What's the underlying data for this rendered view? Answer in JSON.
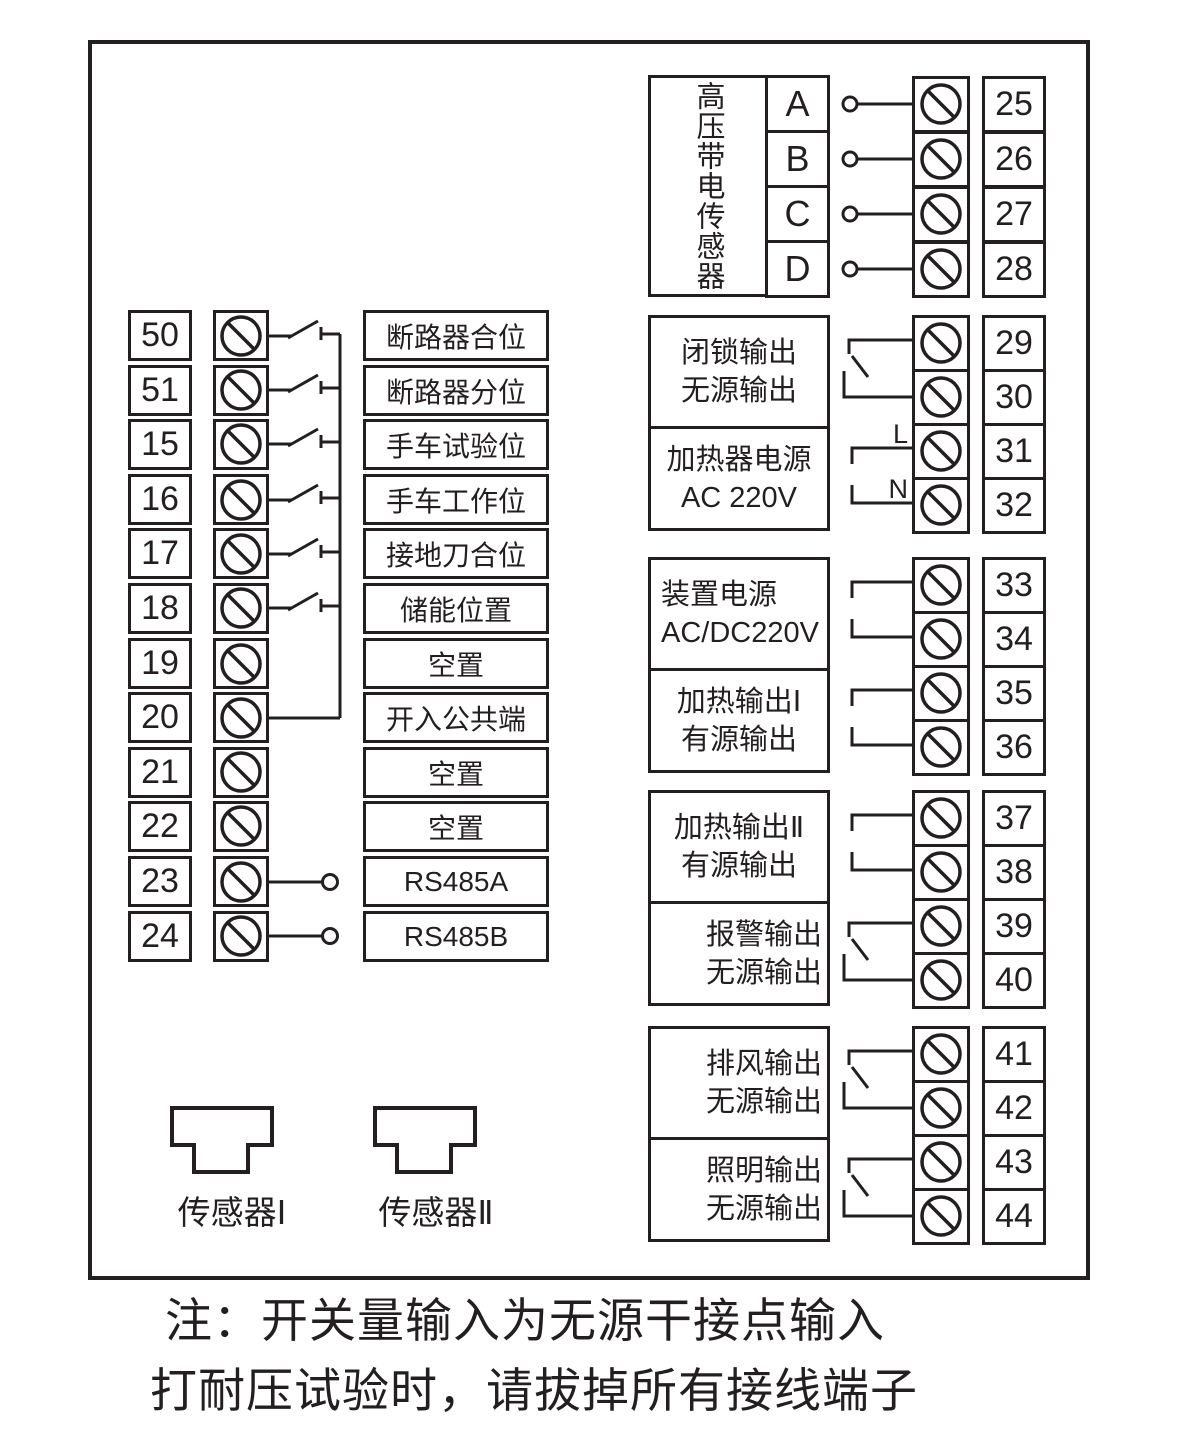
{
  "colors": {
    "ink": "#231f20",
    "background": "#ffffff"
  },
  "hv_sensor": {
    "title": "高压带电传感器",
    "pins": [
      {
        "pin": "A",
        "terminal": "25"
      },
      {
        "pin": "B",
        "terminal": "26"
      },
      {
        "pin": "C",
        "terminal": "27"
      },
      {
        "pin": "D",
        "terminal": "28"
      }
    ]
  },
  "inputs": {
    "rows": [
      {
        "terminal": "50",
        "label": "断路器合位",
        "connector": "switch"
      },
      {
        "terminal": "51",
        "label": "断路器分位",
        "connector": "switch"
      },
      {
        "terminal": "15",
        "label": "手车试验位",
        "connector": "switch"
      },
      {
        "terminal": "16",
        "label": "手车工作位",
        "connector": "switch"
      },
      {
        "terminal": "17",
        "label": "接地刀合位",
        "connector": "switch"
      },
      {
        "terminal": "18",
        "label": "储能位置",
        "connector": "switch"
      },
      {
        "terminal": "19",
        "label": "空置",
        "connector": "none"
      },
      {
        "terminal": "20",
        "label": "开入公共端",
        "connector": "common"
      },
      {
        "terminal": "21",
        "label": "空置",
        "connector": "none"
      },
      {
        "terminal": "22",
        "label": "空置",
        "connector": "none"
      },
      {
        "terminal": "23",
        "label": "RS485A",
        "connector": "circle"
      },
      {
        "terminal": "24",
        "label": "RS485B",
        "connector": "circle"
      }
    ]
  },
  "outputs": {
    "groups": [
      {
        "sections": [
          {
            "line1": "闭锁输出",
            "line2": "无源输出",
            "terminal1": "29",
            "terminal2": "30",
            "connector": "relay"
          },
          {
            "line1": "加热器电源",
            "line2": "AC 220V",
            "terminal1": "31",
            "terminal2": "32",
            "connector": "power",
            "tag1": "L",
            "tag2": "N"
          }
        ]
      },
      {
        "sections": [
          {
            "line1": "装置电源",
            "line2": "AC/DC220V",
            "terminal1": "33",
            "terminal2": "34",
            "connector": "power"
          },
          {
            "line1": "加热输出Ⅰ",
            "line2": "有源输出",
            "terminal1": "35",
            "terminal2": "36",
            "connector": "power"
          }
        ]
      },
      {
        "sections": [
          {
            "line1": "加热输出Ⅱ",
            "line2": "有源输出",
            "terminal1": "37",
            "terminal2": "38",
            "connector": "power"
          },
          {
            "line1": "报警输出",
            "line2": "无源输出",
            "terminal1": "39",
            "terminal2": "40",
            "connector": "relay"
          }
        ]
      },
      {
        "sections": [
          {
            "line1": "排风输出",
            "line2": "无源输出",
            "terminal1": "41",
            "terminal2": "42",
            "connector": "relay"
          },
          {
            "line1": "照明输出",
            "line2": "无源输出",
            "terminal1": "43",
            "terminal2": "44",
            "connector": "relay"
          }
        ]
      }
    ]
  },
  "sensors": {
    "sensor1": "传感器Ⅰ",
    "sensor2": "传感器Ⅱ"
  },
  "note": {
    "line1": "注：开关量输入为无源干接点输入",
    "line2": "打耐压试验时，请拔掉所有接线端子"
  }
}
